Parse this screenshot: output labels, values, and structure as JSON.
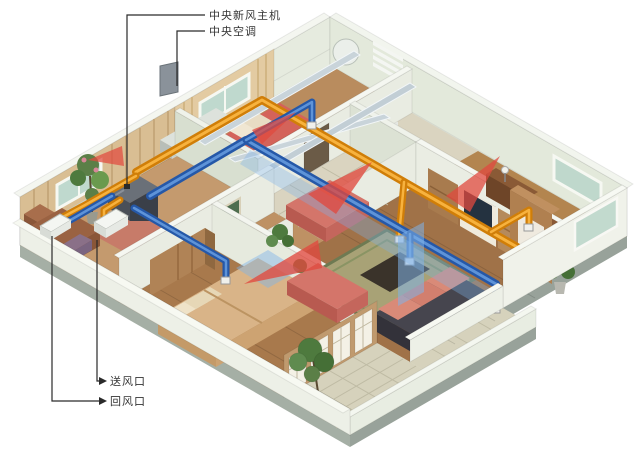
{
  "figure": {
    "description": "isometric cutaway apartment showing central fresh-air HVAC system",
    "background": "#ffffff"
  },
  "callouts": {
    "fresh_air_unit": "中央新风主机",
    "central_ac": "中央空调",
    "supply_outlet": "送风口",
    "return_outlet": "回风口"
  },
  "palette": {
    "supply_duct_orange": "#E8940F",
    "return_duct_blue": "#2F6FBF",
    "warm_airflow_red": "#E0493F",
    "cool_airflow_blue": "#7FB3E8",
    "wall_green": "#E9ECE2",
    "wood_floor": "#B5854F",
    "tile_floor": "#D6D2BC",
    "unit_box": "#4A4F58",
    "leader_line": "#2A2A2A"
  }
}
